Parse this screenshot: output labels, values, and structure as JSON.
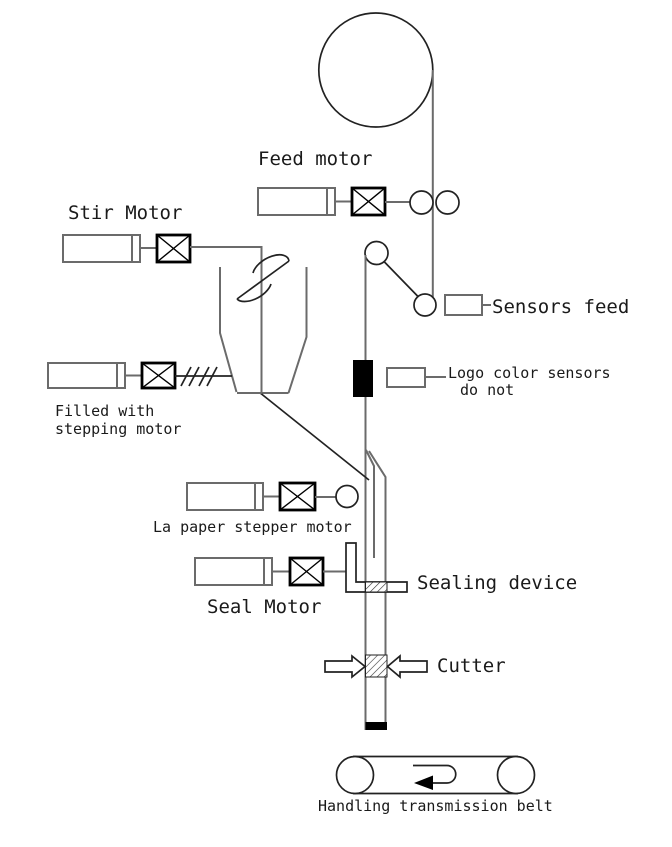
{
  "diagram": {
    "labels": {
      "feed_motor": "Feed motor",
      "stir_motor": "Stir Motor",
      "filled_with": {
        "line1": "Filled with",
        "line2": "stepping motor"
      },
      "la_paper_motor": "La paper stepper motor",
      "seal_motor": "Seal Motor",
      "sensors_feed": "Sensors feed",
      "logo_sensors": {
        "line1": "Logo color sensors",
        "line2": "do not"
      },
      "sealing_device": "Sealing device",
      "cutter": "Cutter",
      "belt": "Handling transmission belt"
    },
    "colors": {
      "machine_line": "#6b6b6b",
      "detail_line": "#222222",
      "coupling_border": "#000000",
      "mark_fill": "#000000",
      "background": "#ffffff"
    }
  }
}
